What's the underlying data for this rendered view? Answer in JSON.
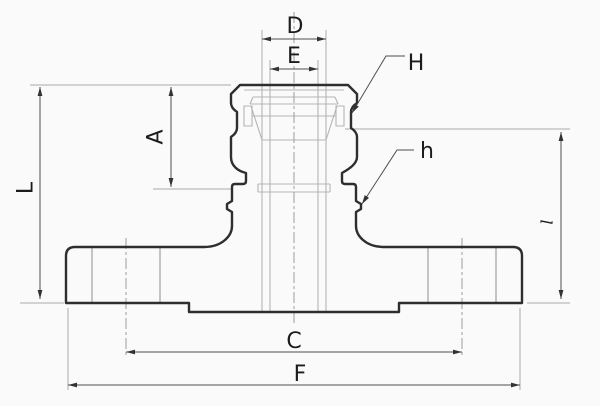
{
  "figure": {
    "kind": "engineering-section-drawing",
    "colors": {
      "background": "#fafafa",
      "outline": "#2e2e2e",
      "internal_lines": "#b5b5b5",
      "dimension_lines": "#4d4d4d",
      "centerlines": "#9c9c9c",
      "label_text": "#1c1c1c"
    },
    "labels": {
      "D": "D",
      "E": "E",
      "H": "H",
      "A": "A",
      "L": "L",
      "h": "h",
      "l": "l",
      "C": "C",
      "F": "F"
    }
  }
}
